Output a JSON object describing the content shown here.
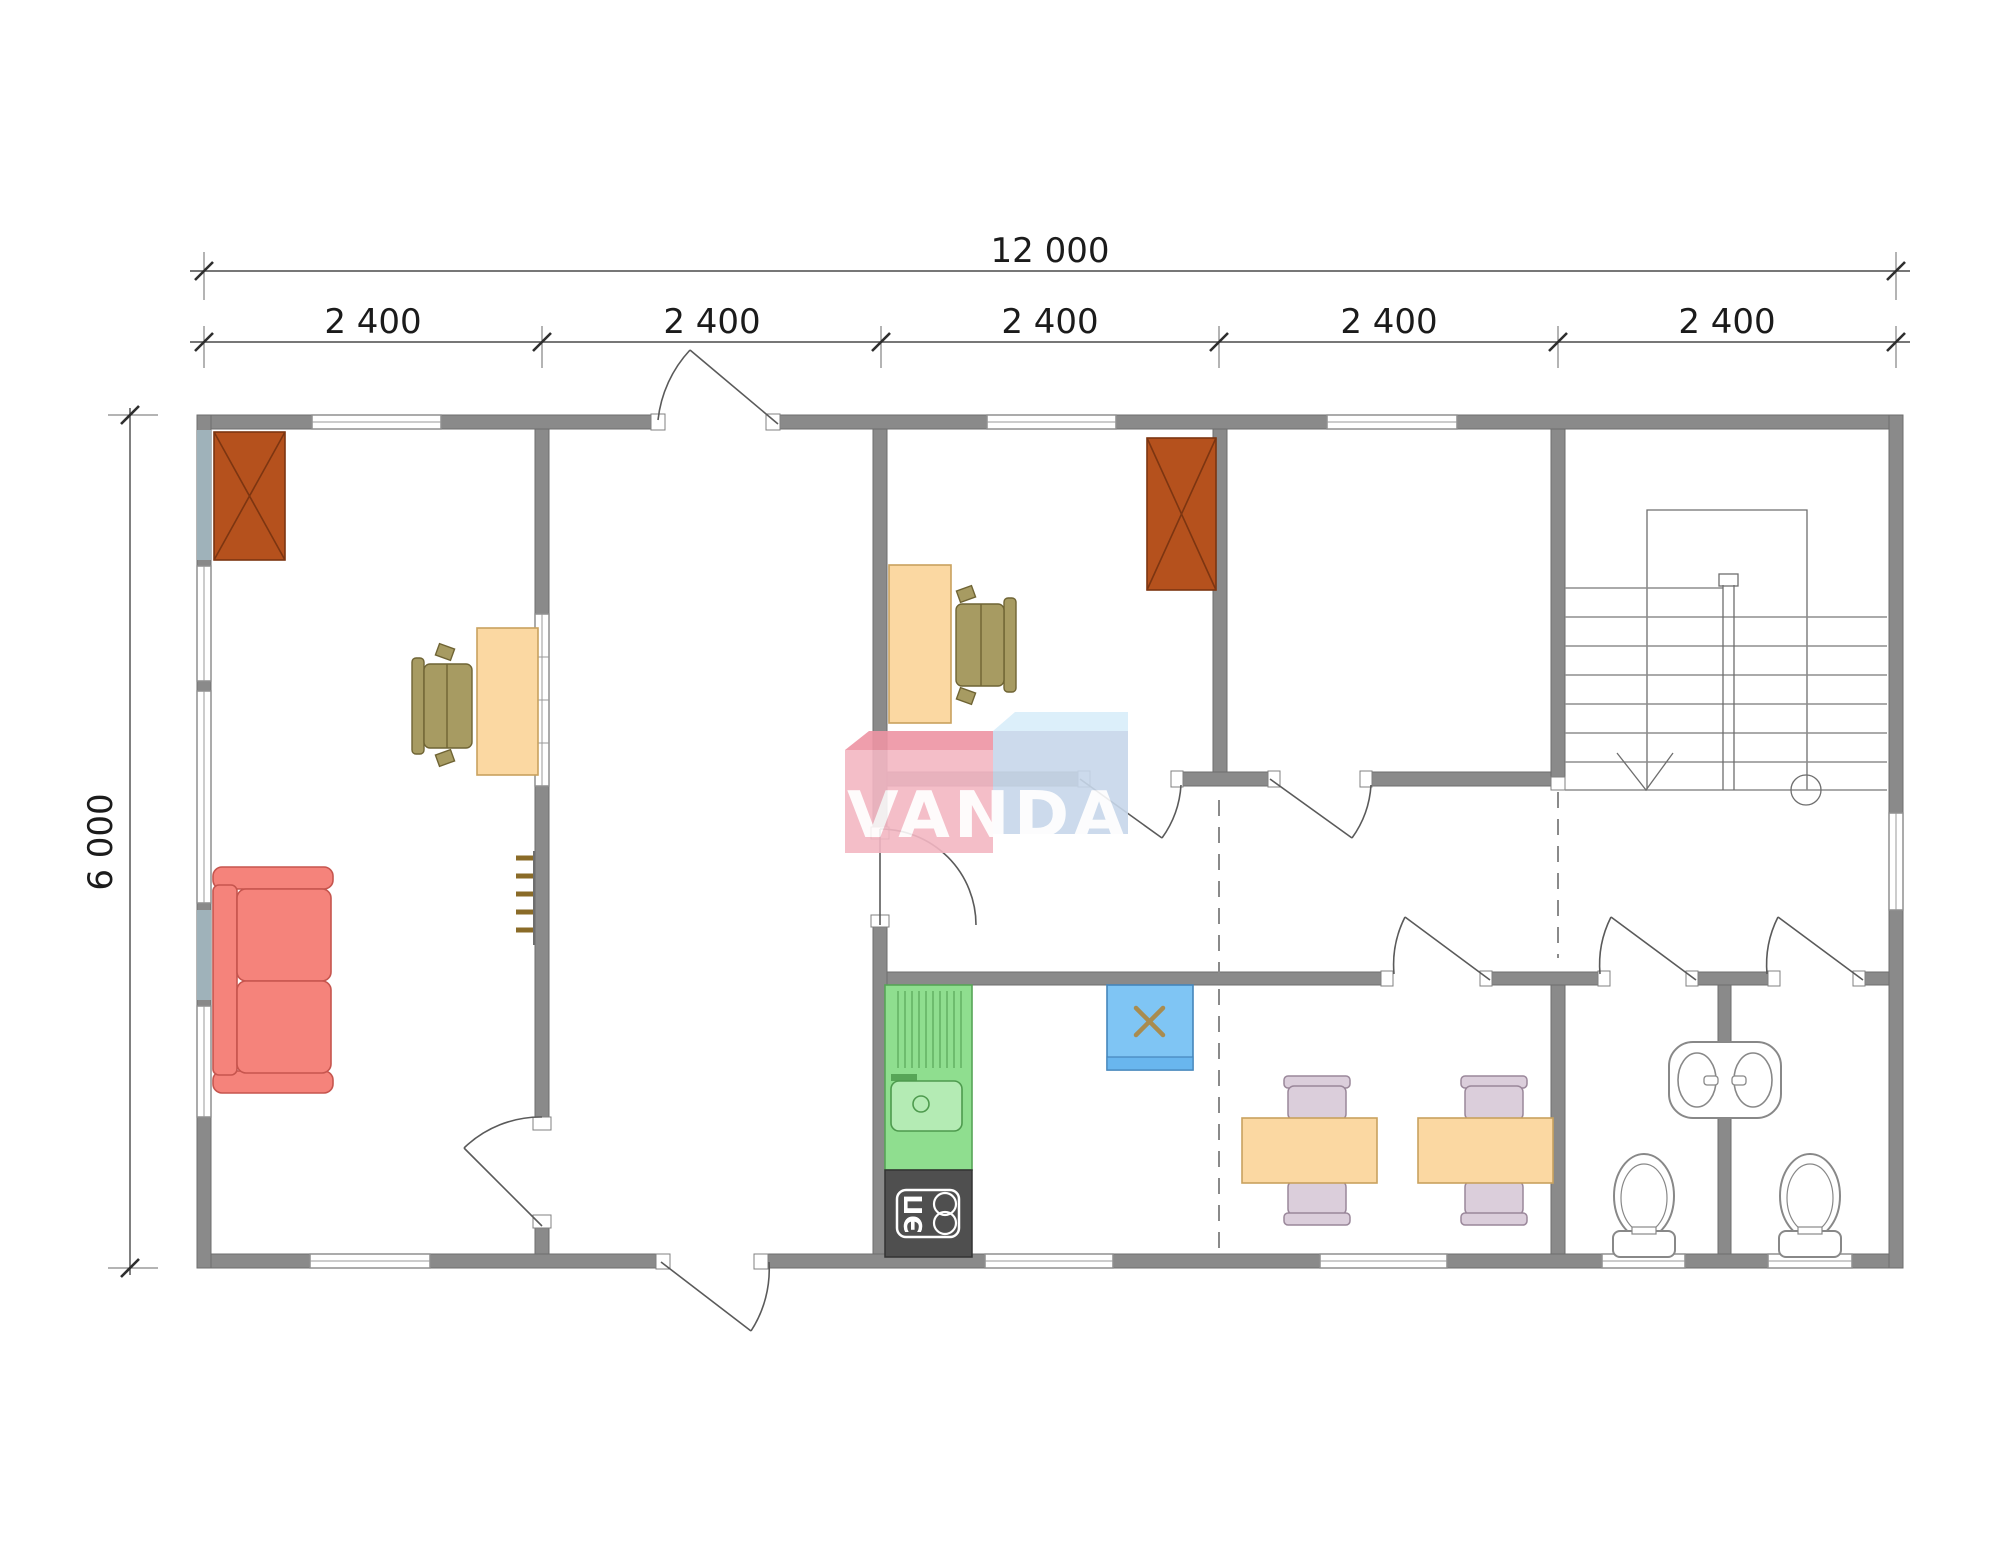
{
  "dimensions": {
    "total_width_label": "12 000",
    "total_height_label": "6 000",
    "segment_labels": [
      "2 400",
      "2 400",
      "2 400",
      "2 400",
      "2 400"
    ]
  },
  "watermark": {
    "text": "VANDA"
  },
  "kitchen": {
    "stove_label": "ЭП"
  },
  "colors": {
    "wall": "#8a8a8a",
    "wall_accent": "#9fb2ba",
    "fireplace": "#b5511d",
    "desk": "#fbd8a2",
    "office_chair": "#a79b62",
    "sofa": "#f5837b",
    "kitchen_unit": "#8fde8f",
    "kitchen_sink": "#b4ebb4",
    "stove": "#4f4f4f",
    "fridge": "#7fc5f4",
    "fridge_band": "#69b6ee",
    "fridge_mark": "#a98c4f",
    "table": "#fbd8a2",
    "dining_chair": "#dbcedb",
    "fixture": "#ffffff",
    "towel_rail": "#8a6b28",
    "logo_pink": "#f3b7c3",
    "logo_pink_top": "#ee94a4",
    "logo_blue": "#c7d7ea",
    "logo_blue_top": "#d9eefa",
    "logo_text": "#ffffff"
  },
  "symbols": [
    "fireplace-symbol",
    "desk-symbol",
    "office-chair-symbol",
    "sofa-symbol",
    "towel-rail-symbol",
    "kitchen-sink-symbol",
    "electric-stove-symbol",
    "fridge-symbol",
    "dining-table-symbol",
    "dining-chair-symbol",
    "stairs-symbol",
    "vanity-sink-symbol",
    "toilet-symbol",
    "door-swing-symbol",
    "window-symbol"
  ]
}
